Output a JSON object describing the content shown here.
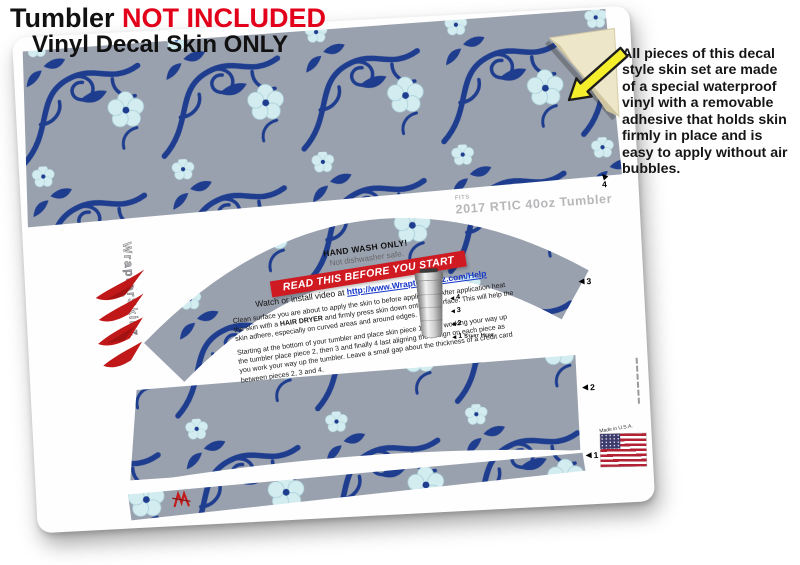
{
  "header": {
    "line1_black": "Tumbler ",
    "line1_red": "NOT INCLUDED",
    "line2": "Vinyl Decal Skin ONLY"
  },
  "note": {
    "text": "All pieces of this decal style skin set are made of a special waterproof vinyl with a removable adhesive that holds skin firmly in place and is easy to apply without air bubbles."
  },
  "sheet": {
    "fits_small": "FITS",
    "fits_main": "2017 RTIC 40oz Tumbler",
    "logo_text": "WraptorSkinz",
    "made_in": "Made in U.S.A.",
    "markers": {
      "p4": "4",
      "p3": "3",
      "p2": "2",
      "p1": "1"
    },
    "guide": {
      "m4": "4",
      "m3": "3",
      "m2": "2",
      "m1": "1",
      "start_here": "Start Here"
    },
    "care": {
      "hand_wash": "HAND WASH ONLY!",
      "dishwasher": "Not dishwasher safe.",
      "banner": "READ THIS BEFORE YOU START",
      "video_prefix": "Watch or install video at ",
      "video_url": "http://www.WraptorSkinz.com/Help",
      "para1_a": "Clean surface you are about to apply the skin to before application. After application heat the skin with a ",
      "para1_bold": "HAIR DRYER",
      "para1_b": " and firmly press skin down onto the surface. This will help the skin adhere, especially on curved areas and around edges.",
      "para2": "Starting at the bottom of your tumbler and place skin piece 1. Then working your way up the tumbler place piece 2, then 3 and finally 4 last aligning the design on each piece as you work your way up the tumbler. Leave a small gap about the thickness of a credit card between pieces 2, 3 and 4."
    }
  },
  "colors": {
    "header_red": "#e2001a",
    "banner_red": "#cf1a22",
    "pattern_background": "#9aa1ae",
    "vine_navy": "#1e3d8f",
    "flower_blue": "#d2ecf0",
    "link_blue": "#1536c9",
    "arrow_yellow": "#f4ee2b",
    "backing_cream": "#ede6c8"
  }
}
